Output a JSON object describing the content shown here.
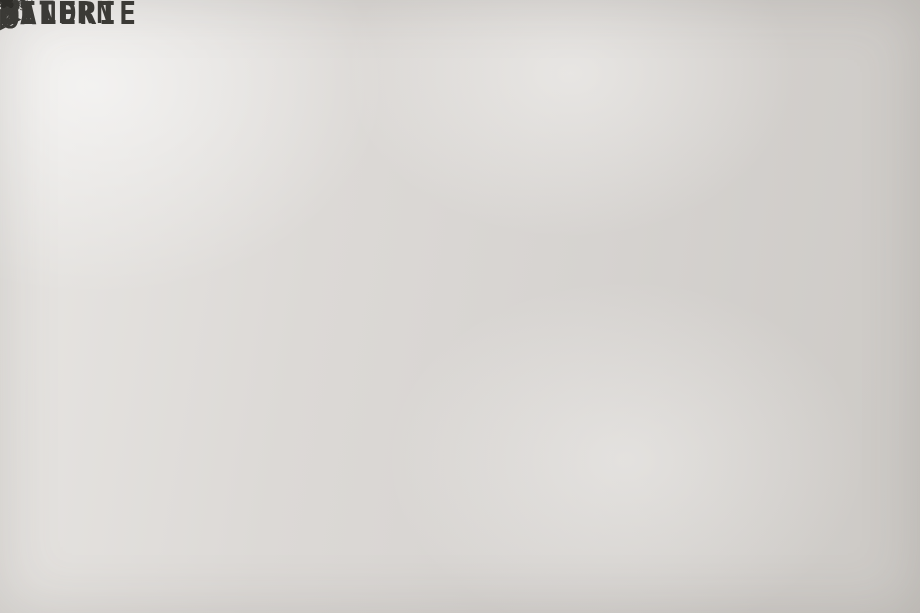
{
  "palette": {
    "highlight": "#2BA6E0",
    "ink": "#3B3A36"
  },
  "rooms": {
    "eltern": "ELTERN",
    "galerie": "GALERIE",
    "kind": "KIND"
  },
  "stair_left": {
    "steps": "16 ST 18.7/27",
    "run": "320",
    "width": "100",
    "flight": "100"
  },
  "stair_right": {
    "steps": "16 ST 18.7/27",
    "width": "100",
    "lower": "107"
  },
  "dims": {
    "top_390": "390",
    "d50": "50",
    "d10": "10",
    "d110": "110",
    "d300": "300",
    "d2": "2",
    "shaft10": "10",
    "shaft28": "28",
    "shaft38": "38",
    "br38": "38"
  },
  "pipes": {
    "p110a": "Φ110",
    "p110b": "Φ110",
    "p125": "125",
    "p100": "100",
    "p110c": "-110",
    "p57": "57",
    "p38": "38",
    "p175": "Φ175",
    "p125b": "Φ125"
  },
  "fixtures": {
    "fbh": "FBH-V",
    "d87": "87",
    "d8": "8"
  },
  "shafts": {
    "vs57": "VS57",
    "vs": "VS",
    "sym": "Ø"
  }
}
